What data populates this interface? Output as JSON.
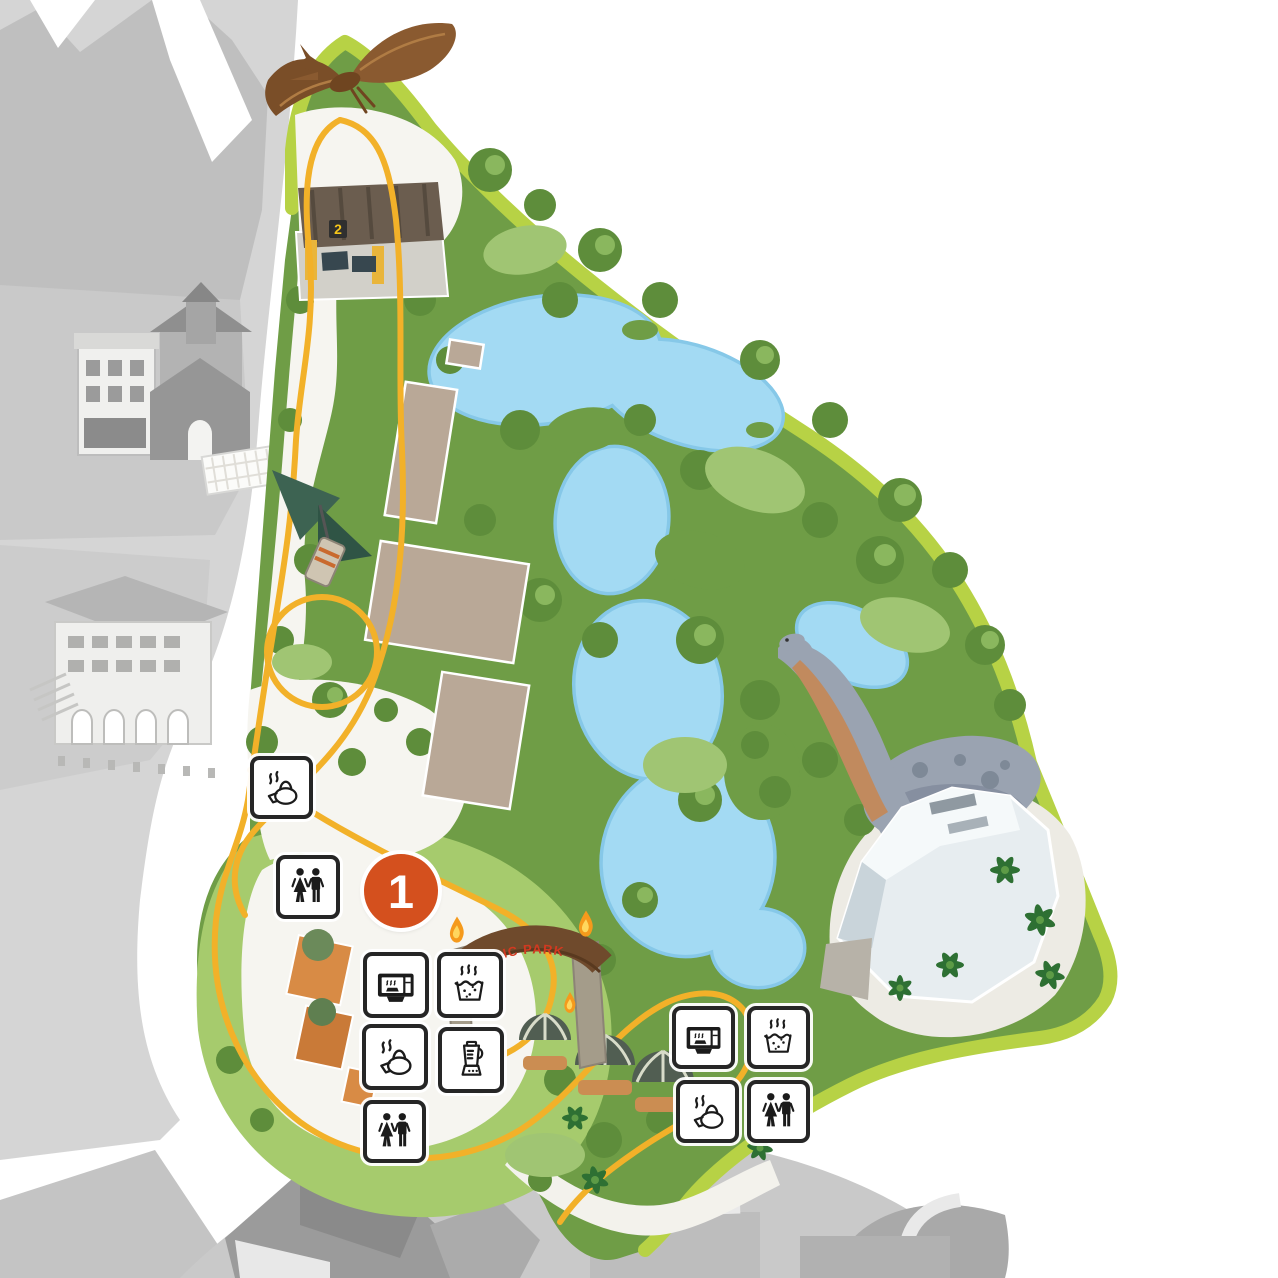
{
  "map": {
    "title": "theme-park-zone-map",
    "zone_marker": {
      "label": "1",
      "color": "#d4501e",
      "x": 401,
      "y": 891,
      "r": 37
    },
    "station_badge": {
      "label": "2",
      "color": "#f5c51a"
    },
    "gate_sign": {
      "text": "JURASSIC PARK",
      "color": "#d23920"
    },
    "colors": {
      "park_green": "#6f9d46",
      "park_border_lime": "#b7d245",
      "tree_dark_green": "#5e8d3b",
      "lawn_light_green": "#a6cb6d",
      "water_blue": "#a3daf3",
      "water_edge_blue": "#86c8e8",
      "path_white": "#f6f5f0",
      "building_tan": "#b9a897",
      "other_zone_grey": "#d5d5d5",
      "ride_track_yellow": "#f2b129",
      "icon_border_black": "#262626",
      "flame_orange": "#f59a1c"
    },
    "amenities": [
      {
        "id": "kettle-west",
        "type": "hot-kettle",
        "x": 250,
        "y": 756,
        "size": 63
      },
      {
        "id": "restroom-west",
        "type": "restroom",
        "x": 276,
        "y": 855,
        "size": 64
      },
      {
        "id": "microwave-center",
        "type": "microwave",
        "x": 363,
        "y": 952,
        "size": 66
      },
      {
        "id": "hot-water-center",
        "type": "hot-water",
        "x": 437,
        "y": 952,
        "size": 66
      },
      {
        "id": "kettle-center",
        "type": "hot-kettle",
        "x": 362,
        "y": 1024,
        "size": 66
      },
      {
        "id": "blender-center",
        "type": "blender",
        "x": 438,
        "y": 1027,
        "size": 66
      },
      {
        "id": "restroom-south",
        "type": "restroom",
        "x": 363,
        "y": 1100,
        "size": 63
      },
      {
        "id": "microwave-east",
        "type": "microwave",
        "x": 672,
        "y": 1006,
        "size": 63
      },
      {
        "id": "hot-water-east",
        "type": "hot-water",
        "x": 747,
        "y": 1006,
        "size": 63
      },
      {
        "id": "kettle-east",
        "type": "hot-kettle",
        "x": 676,
        "y": 1080,
        "size": 63
      },
      {
        "id": "restroom-east",
        "type": "restroom",
        "x": 747,
        "y": 1080,
        "size": 63
      }
    ],
    "illustrations": [
      "pteranodon-flying",
      "canopy-flyer-vehicle",
      "brachiosaurus",
      "jurassic-park-gate",
      "torch-flames",
      "thatched-domes",
      "discovery-building",
      "rapids-river",
      "ride-track-loop"
    ]
  }
}
